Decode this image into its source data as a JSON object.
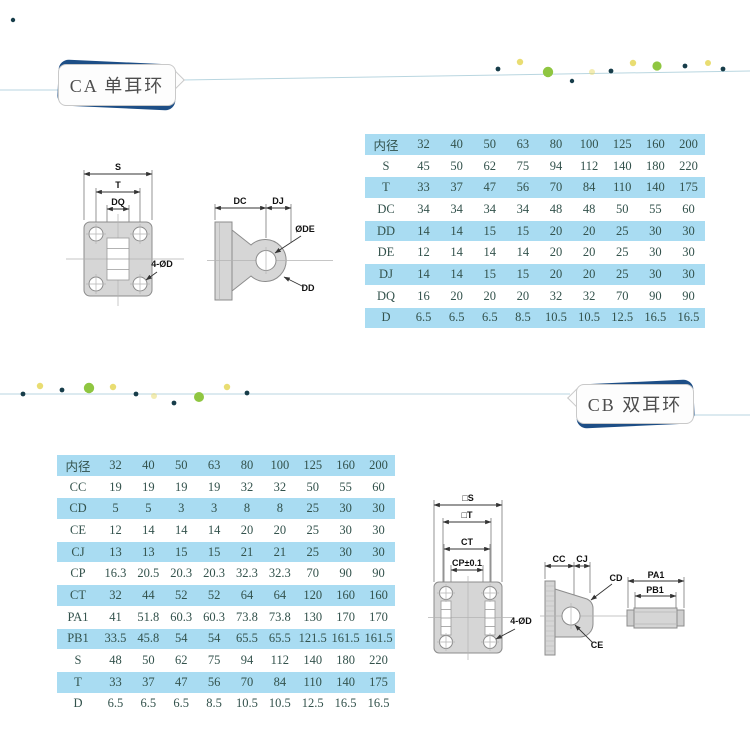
{
  "ca": {
    "title": "CA 单耳环",
    "table": {
      "header": "内径",
      "sizes": [
        "32",
        "40",
        "50",
        "63",
        "80",
        "100",
        "125",
        "160",
        "200"
      ],
      "rows": [
        {
          "label": "S",
          "values": [
            "45",
            "50",
            "62",
            "75",
            "94",
            "112",
            "140",
            "180",
            "220"
          ]
        },
        {
          "label": "T",
          "values": [
            "33",
            "37",
            "47",
            "56",
            "70",
            "84",
            "110",
            "140",
            "175"
          ]
        },
        {
          "label": "DC",
          "values": [
            "34",
            "34",
            "34",
            "34",
            "48",
            "48",
            "50",
            "55",
            "60"
          ]
        },
        {
          "label": "DD",
          "values": [
            "14",
            "14",
            "15",
            "15",
            "20",
            "20",
            "25",
            "30",
            "30"
          ]
        },
        {
          "label": "DE",
          "values": [
            "12",
            "14",
            "14",
            "14",
            "20",
            "20",
            "25",
            "30",
            "30"
          ]
        },
        {
          "label": "DJ",
          "values": [
            "14",
            "14",
            "15",
            "15",
            "20",
            "20",
            "25",
            "30",
            "30"
          ]
        },
        {
          "label": "DQ",
          "values": [
            "16",
            "20",
            "20",
            "20",
            "32",
            "32",
            "70",
            "90",
            "90"
          ]
        },
        {
          "label": "D",
          "values": [
            "6.5",
            "6.5",
            "6.5",
            "8.5",
            "10.5",
            "10.5",
            "12.5",
            "16.5",
            "16.5"
          ]
        }
      ]
    },
    "front": {
      "s": "S",
      "t": "T",
      "dq": "DQ",
      "holes": "4-ØD"
    },
    "side": {
      "dc": "DC",
      "dj": "DJ",
      "de": "ØDE",
      "dd": "DD"
    }
  },
  "cb": {
    "title": "CB 双耳环",
    "table": {
      "header": "内径",
      "sizes": [
        "32",
        "40",
        "50",
        "63",
        "80",
        "100",
        "125",
        "160",
        "200"
      ],
      "rows": [
        {
          "label": "CC",
          "values": [
            "19",
            "19",
            "19",
            "19",
            "32",
            "32",
            "50",
            "55",
            "60"
          ]
        },
        {
          "label": "CD",
          "values": [
            "5",
            "5",
            "3",
            "3",
            "8",
            "8",
            "25",
            "30",
            "30"
          ]
        },
        {
          "label": "CE",
          "values": [
            "12",
            "14",
            "14",
            "14",
            "20",
            "20",
            "25",
            "30",
            "30"
          ]
        },
        {
          "label": "CJ",
          "values": [
            "13",
            "13",
            "15",
            "15",
            "21",
            "21",
            "25",
            "30",
            "30"
          ]
        },
        {
          "label": "CP",
          "values": [
            "16.3",
            "20.5",
            "20.3",
            "20.3",
            "32.3",
            "32.3",
            "70",
            "90",
            "90"
          ]
        },
        {
          "label": "CT",
          "values": [
            "32",
            "44",
            "52",
            "52",
            "64",
            "64",
            "120",
            "160",
            "160"
          ]
        },
        {
          "label": "PA1",
          "values": [
            "41",
            "51.8",
            "60.3",
            "60.3",
            "73.8",
            "73.8",
            "130",
            "170",
            "170"
          ]
        },
        {
          "label": "PB1",
          "values": [
            "33.5",
            "45.8",
            "54",
            "54",
            "65.5",
            "65.5",
            "121.5",
            "161.5",
            "161.5"
          ]
        },
        {
          "label": "S",
          "values": [
            "48",
            "50",
            "62",
            "75",
            "94",
            "112",
            "140",
            "180",
            "220"
          ]
        },
        {
          "label": "T",
          "values": [
            "33",
            "37",
            "47",
            "56",
            "70",
            "84",
            "110",
            "140",
            "175"
          ]
        },
        {
          "label": "D",
          "values": [
            "6.5",
            "6.5",
            "6.5",
            "8.5",
            "10.5",
            "10.5",
            "12.5",
            "16.5",
            "16.5"
          ]
        }
      ]
    },
    "front": {
      "s": "□S",
      "t": "□T",
      "ct": "CT",
      "cp": "CP±0.1",
      "holes": "4-ØD"
    },
    "side": {
      "cc": "CC",
      "cj": "CJ",
      "cd": "CD",
      "ce": "CE"
    },
    "pin": {
      "pa1": "PA1",
      "pb1": "PB1"
    }
  },
  "colors": {
    "accent_navy": "#1d4e86",
    "table_blue": "#a9dcf2",
    "table_text": "#33524c",
    "line_blue": "#b9d6e0",
    "dot_green": "#8fc641",
    "dot_yellow": "#e9dd72",
    "dot_dark": "#173d4a",
    "diagram_gray": "#d6d6d6"
  }
}
